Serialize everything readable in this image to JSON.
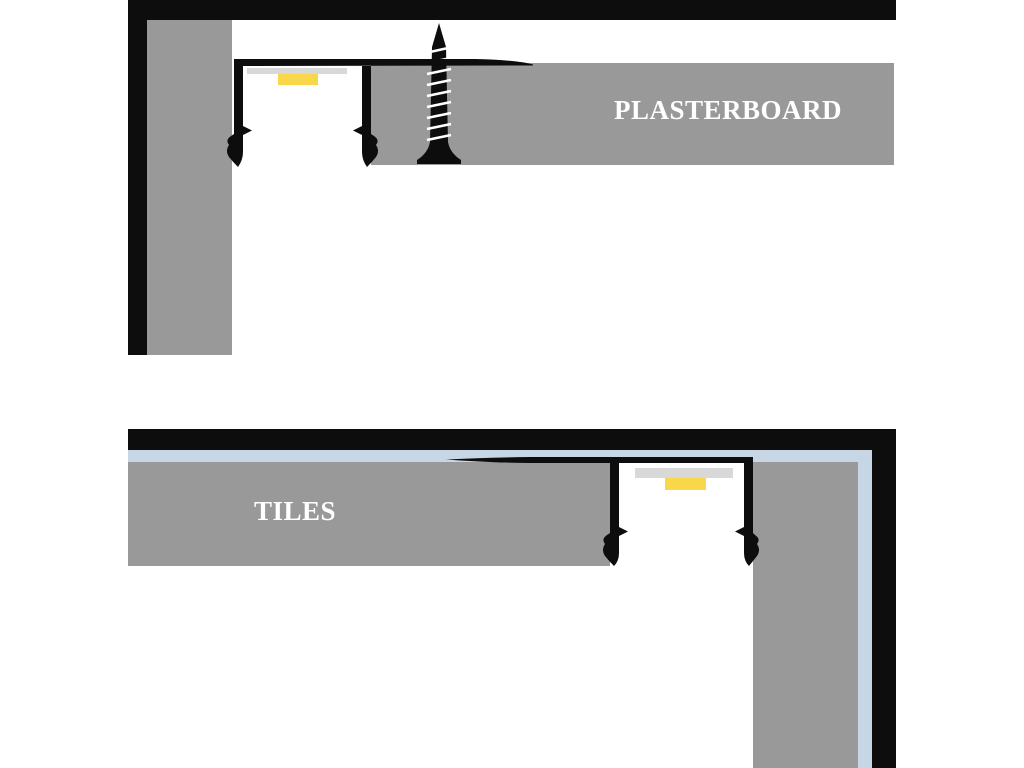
{
  "colors": {
    "ink": "#0d0d0d",
    "material_gray": "#999999",
    "adhesive_blue": "#c6d6e4",
    "led_yellow": "#f8d74b",
    "diffuser_gray": "#d8d8d8",
    "page_white": "#ffffff"
  },
  "diagrams": {
    "plasterboard": {
      "label": "PLASTERBOARD"
    },
    "tiles": {
      "label": "TILES"
    }
  }
}
